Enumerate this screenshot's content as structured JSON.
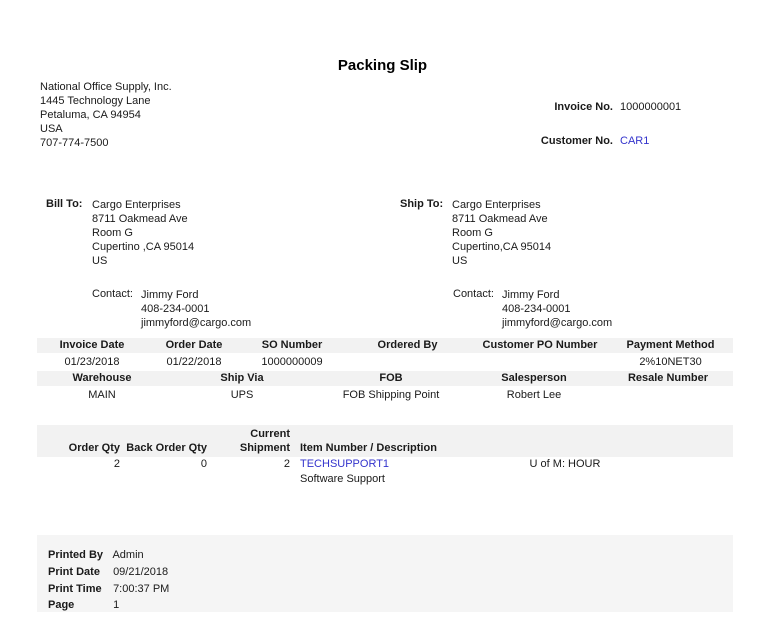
{
  "title": "Packing Slip",
  "company": {
    "name": "National Office Supply, Inc.",
    "address1": "1445 Technology Lane",
    "address2": "Petaluma, CA 94954",
    "country": "USA",
    "phone": "707-774-7500"
  },
  "invoice_no": {
    "label": "Invoice No.",
    "value": "1000000001"
  },
  "customer_no": {
    "label": "Customer No.",
    "value": "CAR1"
  },
  "bill_to": {
    "label": "Bill To:",
    "lines": [
      "Cargo Enterprises",
      "8711 Oakmead Ave",
      "Room G",
      "Cupertino ,CA 95014",
      "US"
    ],
    "contact_label": "Contact:",
    "contact": [
      "Jimmy Ford",
      "408-234-0001",
      "jimmyford@cargo.com"
    ]
  },
  "ship_to": {
    "label": "Ship To:",
    "lines": [
      "Cargo Enterprises",
      "8711 Oakmead Ave",
      "Room G",
      "Cupertino,CA 95014",
      "US"
    ],
    "contact_label": "Contact:",
    "contact": [
      "Jimmy Ford",
      "408-234-0001",
      "jimmyford@cargo.com"
    ]
  },
  "order_info": {
    "headers_row1": [
      "Invoice Date",
      "Order Date",
      "SO Number",
      "Ordered By",
      "Customer PO Number",
      "Payment Method"
    ],
    "values_row1": [
      "01/23/2018",
      "01/22/2018",
      "1000000009",
      "",
      "",
      "2%10NET30"
    ],
    "headers_row2": [
      "Warehouse",
      "Ship Via",
      "FOB",
      "Salesperson",
      "Resale Number"
    ],
    "values_row2": [
      "MAIN",
      "UPS",
      "FOB Shipping Point",
      "Robert Lee",
      ""
    ]
  },
  "line_items": {
    "headers": {
      "order_qty": "Order Qty",
      "back_order_qty": "Back Order Qty",
      "current_shipment_line1": "Current",
      "current_shipment_line2": "Shipment",
      "item": "Item Number / Description"
    },
    "rows": [
      {
        "order_qty": "2",
        "back_order_qty": "0",
        "current_shipment": "2",
        "item_number": "TECHSUPPORT1",
        "uofm": "U of M: HOUR",
        "description": "Software Support"
      }
    ]
  },
  "footer": {
    "rows": [
      {
        "label": "Printed By",
        "value": "Admin"
      },
      {
        "label": "Print Date",
        "value": "09/21/2018"
      },
      {
        "label": "Print Time",
        "value": "7:00:37 PM"
      },
      {
        "label": "Page",
        "value": "1"
      }
    ]
  },
  "colors": {
    "link": "#3333cc",
    "header_band": "#f2f2f2",
    "footer_panel": "#f5f5f5",
    "text": "#1a1a1a"
  }
}
